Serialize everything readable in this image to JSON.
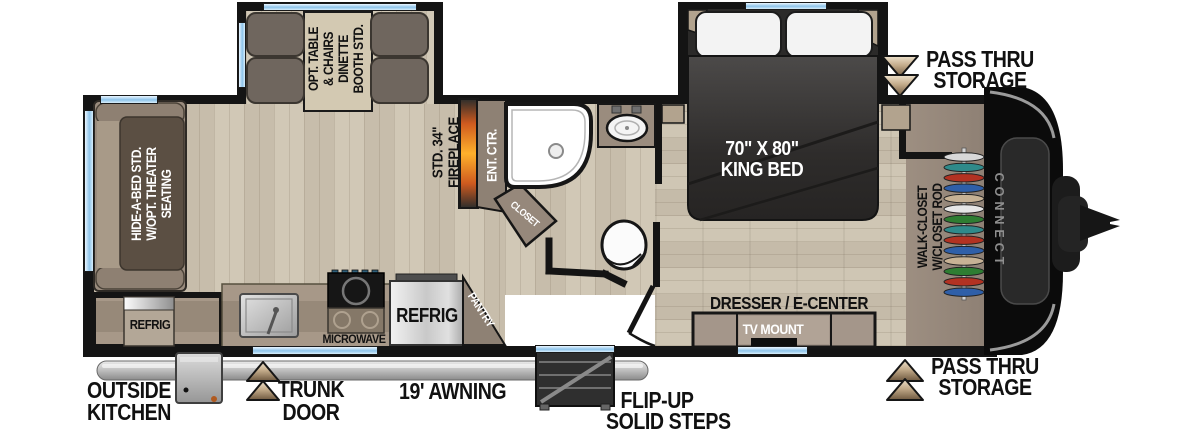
{
  "floorplan": {
    "model_series_logo": "CONNECT",
    "areas": {
      "dinette": {
        "lines": [
          "OPT. TABLE",
          "& CHAIRS",
          "DINETTE",
          "BOOTH STD."
        ]
      },
      "sofa": {
        "lines": [
          "HIDE-A-BED STD.",
          "W/OPT. THEATER",
          "SEATING"
        ]
      },
      "fireplace": {
        "lines": [
          "STD. 34\"",
          "FIREPLACE"
        ]
      },
      "ent_ctr": {
        "label": "ENT. CTR."
      },
      "bath_closet": {
        "label": "CLOSET"
      },
      "king_bed": {
        "lines": [
          "70\" X 80\"",
          "KING BED"
        ]
      },
      "walk_closet": {
        "lines": [
          "WALK-CLOSET",
          "W/CLOSET ROD"
        ]
      },
      "dresser": {
        "label": "DRESSER / E-CENTER"
      },
      "tv_mount": {
        "label": "TV MOUNT"
      },
      "kitchen": {
        "microwave": "MICROWAVE",
        "refrigerator": "REFRIG",
        "pantry": "PANTRY"
      },
      "outside_kitchen_refrig": {
        "label": "REFRIG"
      }
    },
    "callouts": {
      "pass_thru_top": {
        "lines": [
          "PASS THRU",
          "STORAGE"
        ]
      },
      "pass_thru_bottom": {
        "lines": [
          "PASS THRU",
          "STORAGE"
        ]
      },
      "outside_kitchen": {
        "lines": [
          "OUTSIDE",
          "KITCHEN"
        ]
      },
      "trunk_door": {
        "lines": [
          "TRUNK",
          "DOOR"
        ]
      },
      "awning": {
        "label": "19' AWNING"
      },
      "steps": {
        "lines": [
          "FLIP-UP",
          "SOLID STEPS"
        ]
      }
    },
    "closet_hangers": [
      "#d8d8d8",
      "#2f8a8a",
      "#b23222",
      "#2f5fa8",
      "#c7b295",
      "#e6e6e6",
      "#2e7d32",
      "#2f8a8a",
      "#b23222",
      "#2f5fa8",
      "#c7b295",
      "#2e7d32",
      "#b23222",
      "#2f5fa8"
    ],
    "colors": {
      "wall": "#141414",
      "floor_light": "#d1c8b6",
      "floor_dark": "#c7bdab",
      "cabinet": "#a79888",
      "sofa_dark": "#5b4f43",
      "window_blue": "#8ec4ea",
      "fire_orange": "#ffb12b",
      "arrow_tan": "#c3ab8a",
      "bed_dark": "#2e2c2b",
      "logo_gray": "#8f8f8f"
    }
  }
}
